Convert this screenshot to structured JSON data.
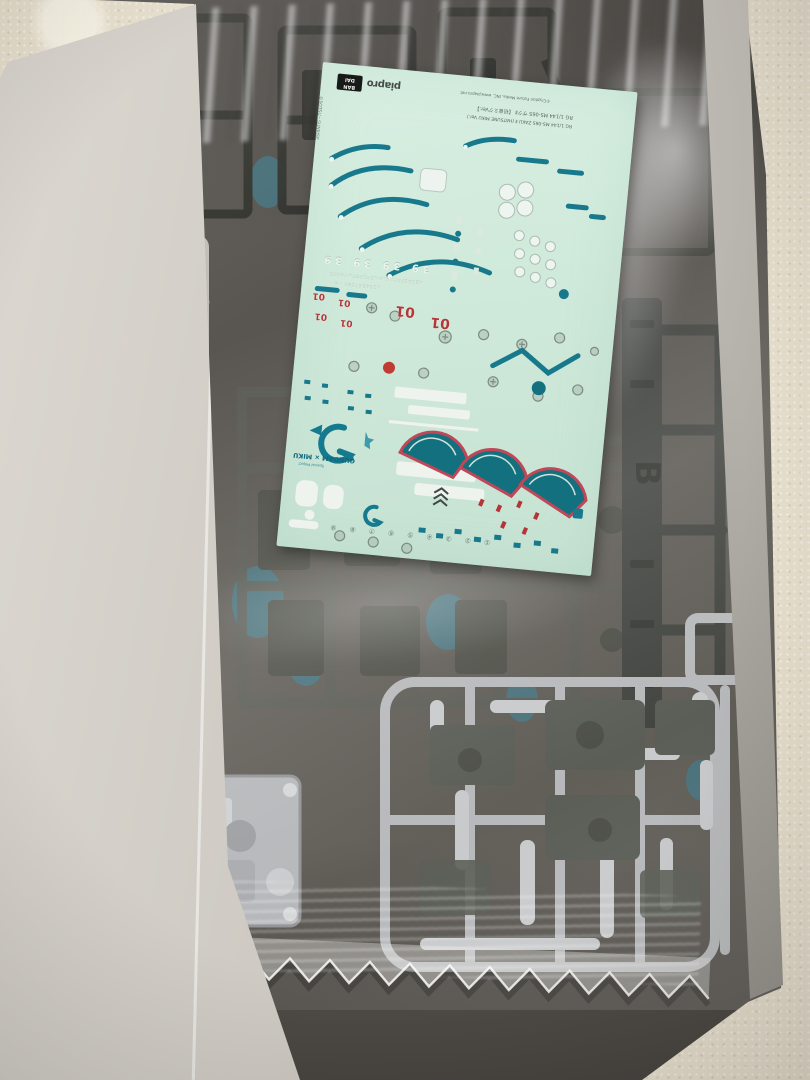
{
  "photo": {
    "floor_color": "#eae2d0",
    "box": {
      "left_wall_color": "#cecac3",
      "right_wall_color": "#a7a49e",
      "interior_color": "#54514b"
    },
    "runners": {
      "gate_letter": "B",
      "dark_color": "#2a2c28",
      "gray_color": "#50534d",
      "silver_color": "#b8babd",
      "clear_color": "#e3e1da",
      "blue_color": "#2f7d96"
    },
    "decal_sheet": {
      "background_color": "#cfe9da",
      "teal": "#17758a",
      "red": "#b83838",
      "white": "#eff5f0",
      "header": {
        "edge_copyright": "©SOTSU・SUNRISE",
        "bandai_line1": "BAN",
        "bandai_line2": "DAI",
        "piapro": "piapro",
        "piapro_copyright": "©Crypton Future Media, INC. www.piapro.net",
        "product_jp": "RG 1/144 MS-06S ザクⅡ 【初音ミクVer.】",
        "product_en": "RG 1/144 MS-06S ZAKU Ⅱ (HATSUNE MIKU Ver.)"
      },
      "markings": {
        "thirty_nine": "39 39 39 39",
        "alphabet_strip": "ABCDEFGHIJKLMNOPQRSTUVWXYZ",
        "number_strip": "1234567890・&",
        "zero_one": "01",
        "logo_text": "GUNDAM × MIKU",
        "logo_subtext": "Special Project",
        "circled_numbers": [
          "①",
          "②",
          "③",
          "④",
          "⑤",
          "⑥",
          "⑦",
          "⑧",
          "⑨"
        ]
      }
    }
  }
}
